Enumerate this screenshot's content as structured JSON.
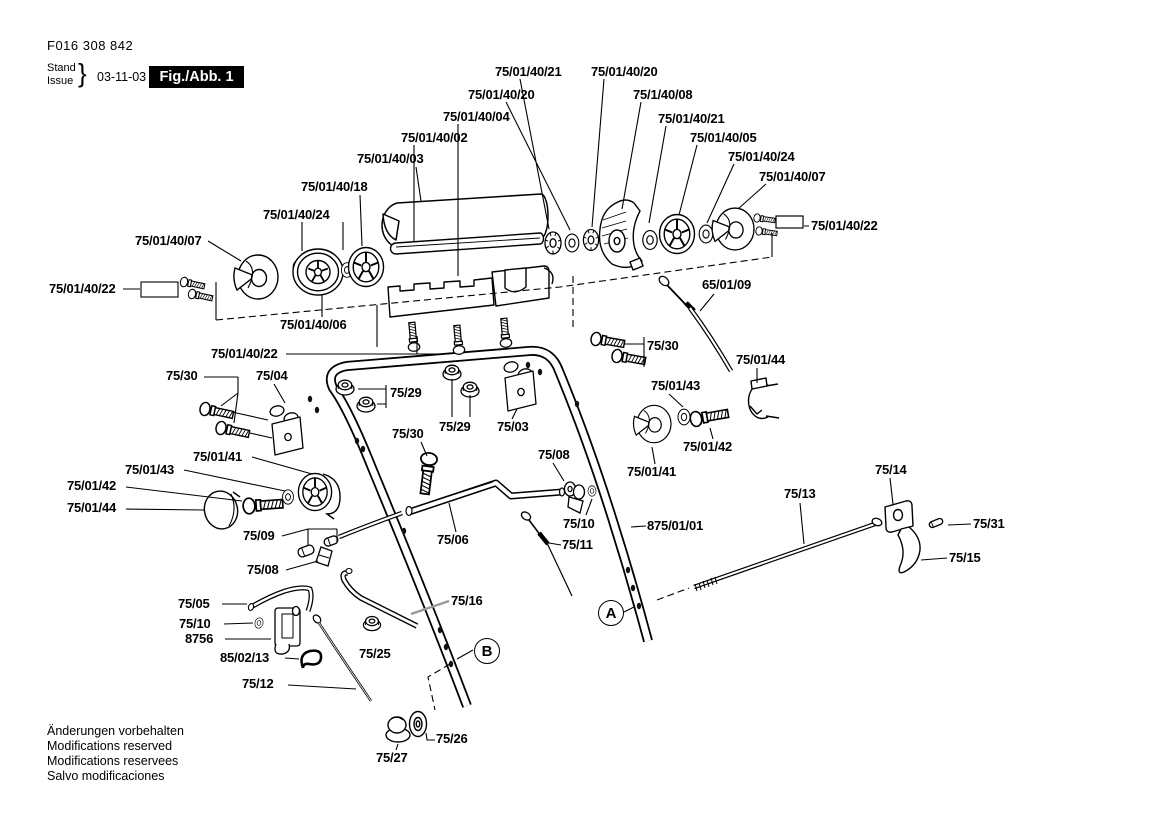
{
  "header": {
    "doc_number": "F016 308 842",
    "stand_label": "Stand",
    "issue_label": "Issue",
    "brace": "}",
    "date": "03-11-03",
    "figure_label": "Fig./Abb. 1"
  },
  "footer": {
    "lines": [
      "Änderungen vorbehalten",
      "Modifications reserved",
      "Modifications reservees",
      "Salvo modificaciones"
    ]
  },
  "view_markers": [
    {
      "letter": "A"
    },
    {
      "letter": "B"
    }
  ],
  "colors": {
    "ink": "#000000",
    "paper": "#ffffff",
    "figure_box_bg": "#000000",
    "figure_box_text": "#ffffff"
  },
  "part_labels": [
    {
      "text": "75/01/40/21"
    },
    {
      "text": "75/01/40/20"
    },
    {
      "text": "75/01/40/20"
    },
    {
      "text": "75/1/40/08"
    },
    {
      "text": "75/01/40/04"
    },
    {
      "text": "75/01/40/21"
    },
    {
      "text": "75/01/40/02"
    },
    {
      "text": "75/01/40/05"
    },
    {
      "text": "75/01/40/24"
    },
    {
      "text": "75/01/40/07"
    },
    {
      "text": "75/01/40/03"
    },
    {
      "text": "75/01/40/18"
    },
    {
      "text": "75/01/40/24"
    },
    {
      "text": "75/01/40/07"
    },
    {
      "text": "75/01/40/22"
    },
    {
      "text": "75/01/40/22"
    },
    {
      "text": "65/01/09"
    },
    {
      "text": "75/01/40/06"
    },
    {
      "text": "75/01/40/22"
    },
    {
      "text": "75/30"
    },
    {
      "text": "75/04"
    },
    {
      "text": "75/29"
    },
    {
      "text": "75/29"
    },
    {
      "text": "75/03"
    },
    {
      "text": "75/30"
    },
    {
      "text": "75/01/44"
    },
    {
      "text": "75/01/43"
    },
    {
      "text": "75/30"
    },
    {
      "text": "75/08"
    },
    {
      "text": "75/01/42"
    },
    {
      "text": "75/01/41"
    },
    {
      "text": "75/01/41"
    },
    {
      "text": "75/01/43"
    },
    {
      "text": "75/01/42"
    },
    {
      "text": "75/01/44"
    },
    {
      "text": "75/09"
    },
    {
      "text": "75/06"
    },
    {
      "text": "75/10"
    },
    {
      "text": "75/11"
    },
    {
      "text": "875/01/01"
    },
    {
      "text": "75/08"
    },
    {
      "text": "75/13"
    },
    {
      "text": "75/14"
    },
    {
      "text": "75/05"
    },
    {
      "text": "75/10"
    },
    {
      "text": "8756"
    },
    {
      "text": "75/31"
    },
    {
      "text": "75/15"
    },
    {
      "text": "75/16"
    },
    {
      "text": "85/02/13"
    },
    {
      "text": "75/25"
    },
    {
      "text": "75/12"
    },
    {
      "text": "75/26"
    },
    {
      "text": "75/27"
    }
  ]
}
